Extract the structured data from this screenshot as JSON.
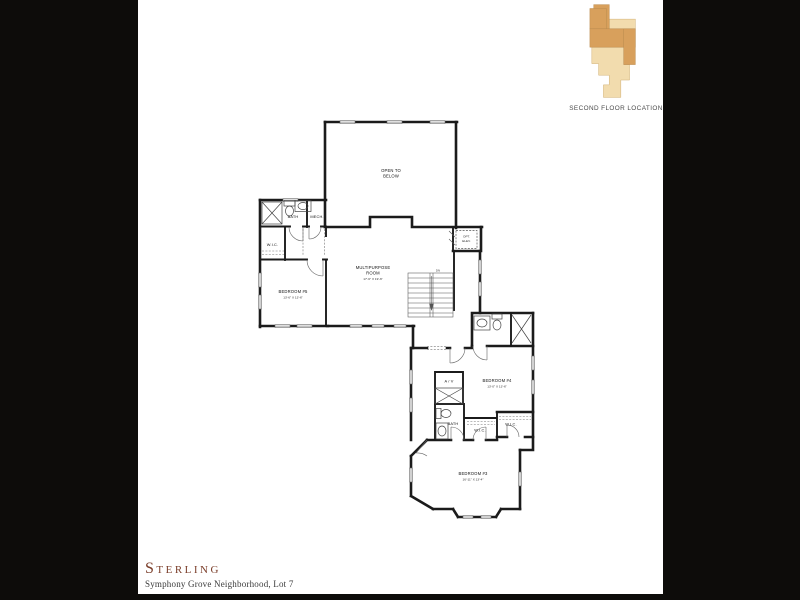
{
  "location_key": {
    "caption": "SECOND FLOOR LOCATION"
  },
  "footer": {
    "plan_name": "Sterling",
    "subtitle": "Symphony Grove Neighborhood, Lot 7"
  },
  "plan": {
    "open_to_below_1": "OPEN TO",
    "open_to_below_2": "BELOW",
    "bath_upper": "BATH",
    "mech": "MECH.",
    "wic_upper": "W.I.C.",
    "bedroom5": "BEDROOM #5",
    "bedroom5_dim": "13'-6\" X 13'-6\"",
    "multipurpose_1": "MULTIPURPOSE",
    "multipurpose_2": "ROOM",
    "multipurpose_dim": "17'-6\" X 19'-6\"",
    "opt_elev_1": "OPT.",
    "opt_elev_2": "ELEV.",
    "stairs_dn": "DN",
    "av": "A / V",
    "bedroom4": "BEDROOM #4",
    "bedroom4_dim": "13'-0\" X 13'-6\"",
    "bath_lower": "BATH",
    "wic_bedroom3": "W.I.C.",
    "wic_bedroom4": "W.I.C.",
    "bedroom3": "BEDROOM #3",
    "bedroom3_dim": "16'-11\" X 13'-4\""
  },
  "colors": {
    "letterbox": "#0d0c0a",
    "paper": "#ffffff",
    "wall": "#1b1b1b",
    "key_dark_tan": "#d8a05c",
    "key_light_tan": "#f2dcae",
    "plan_name_color": "#7b3e2a"
  }
}
